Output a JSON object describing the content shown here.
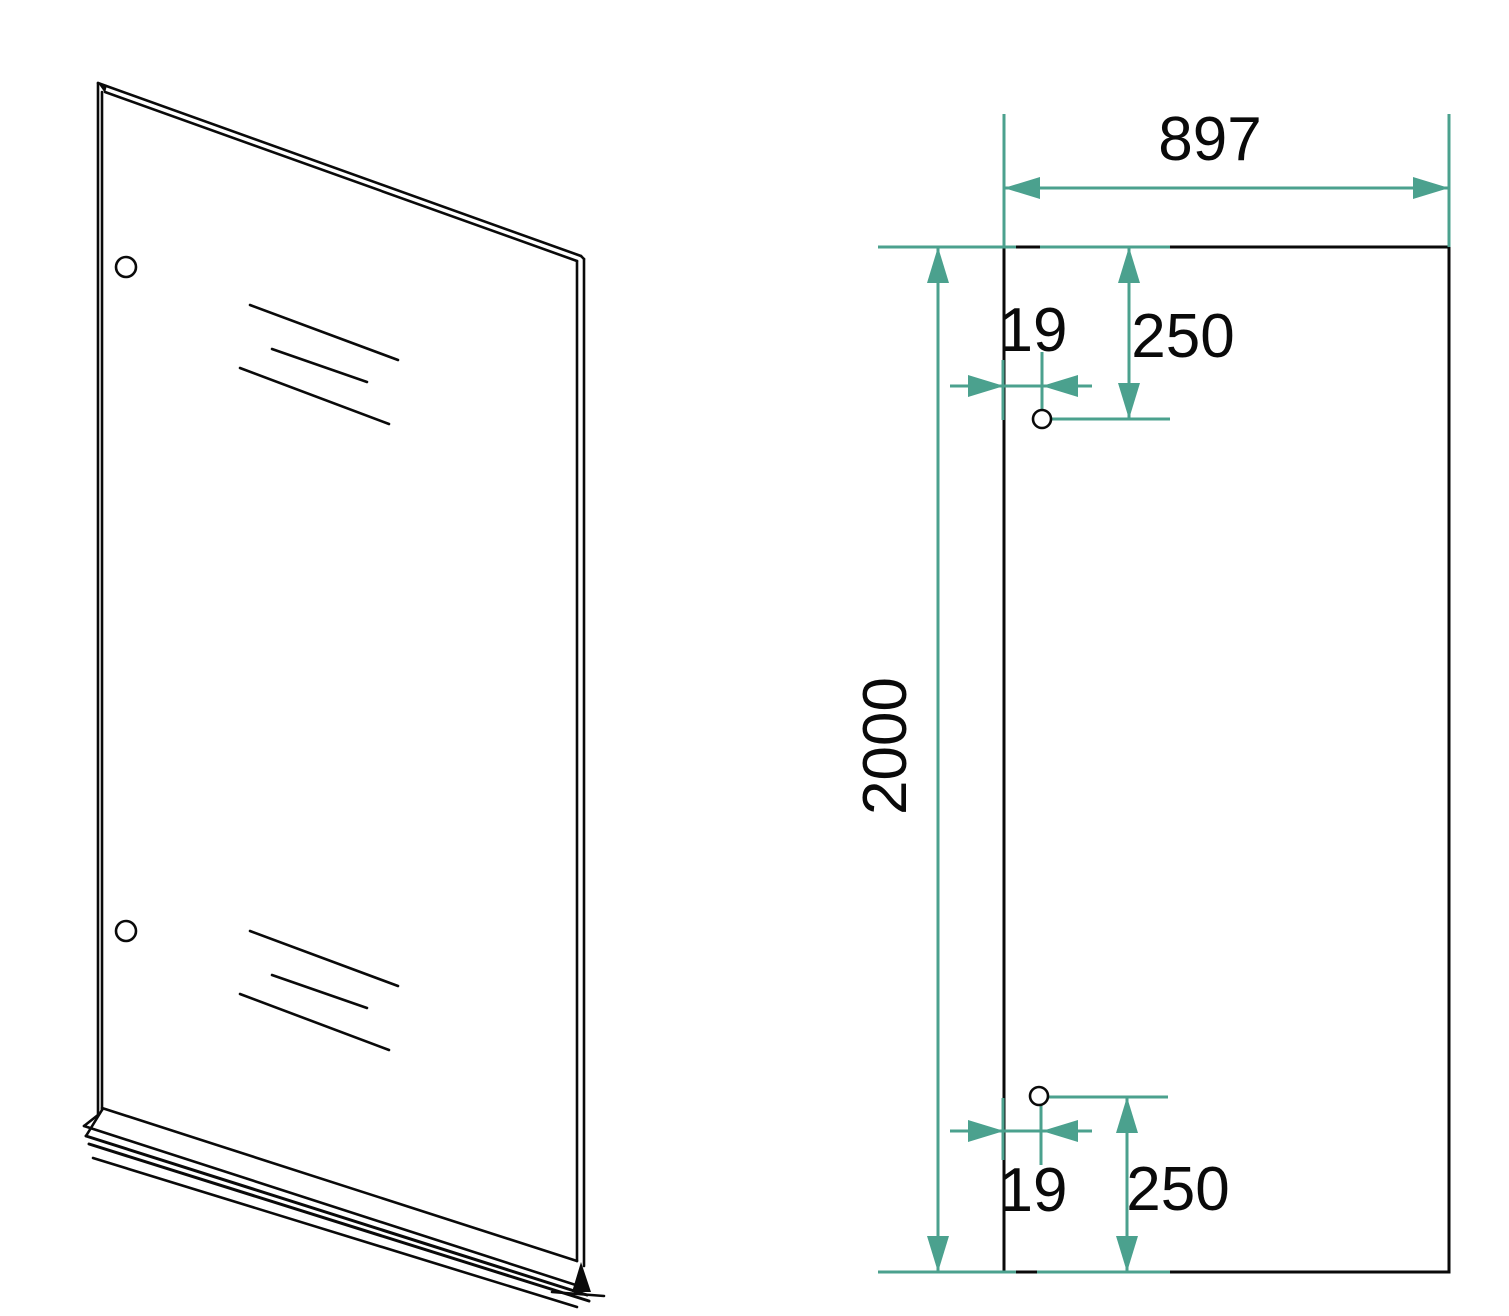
{
  "colors": {
    "accent": "#4BA18E",
    "ink": "#0A0A0A",
    "background": "#FFFFFF"
  },
  "front_view": {
    "width_label": "897",
    "height_label": "2000",
    "top_hole": {
      "edge_offset_label": "19",
      "from_top_label": "250"
    },
    "bottom_hole": {
      "edge_offset_label": "19",
      "from_bottom_label": "250"
    }
  }
}
